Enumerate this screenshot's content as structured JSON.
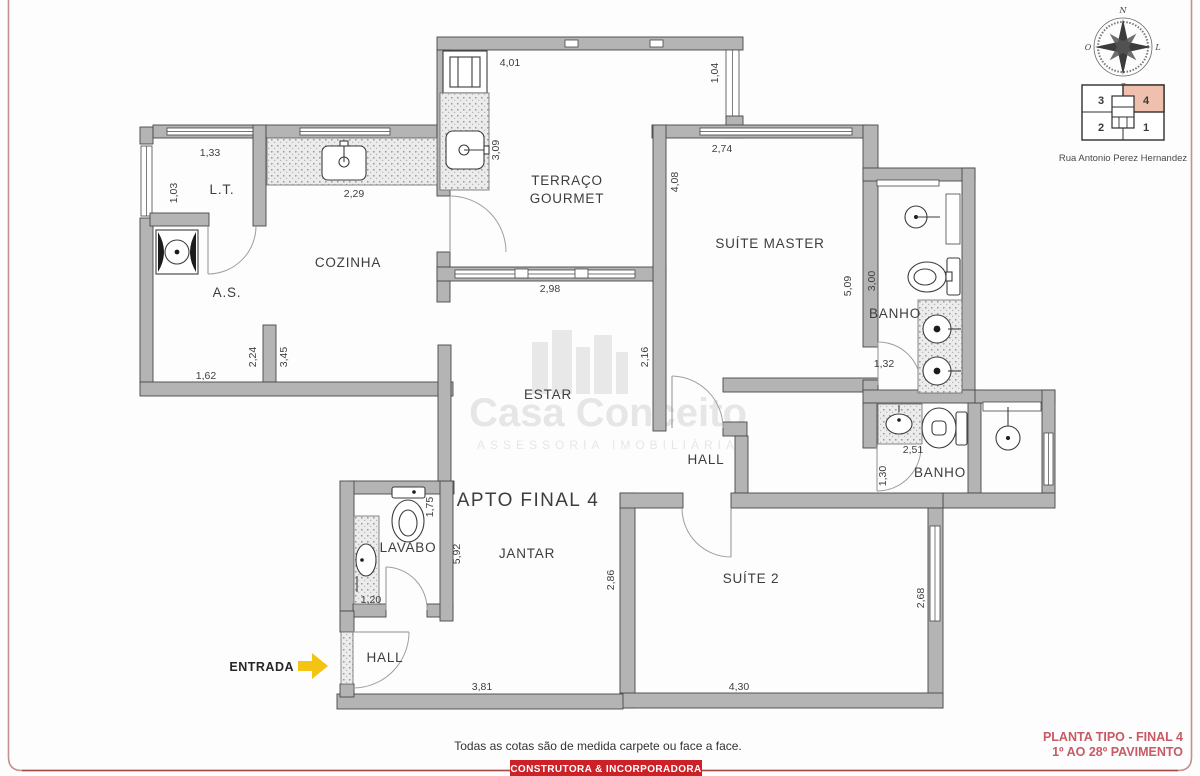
{
  "palette": {
    "wall_gray": "#b4b4b4",
    "accent_red": "#cb2127",
    "title_red": "#c75a64",
    "border_pink": "#c2928e",
    "arrow_yellow": "#f4c412",
    "keyplan_highlight": "#eec0ad"
  },
  "rooms": {
    "lt": "L.T.",
    "servico": "A.S.",
    "cozinha": "COZINHA",
    "terraco1": "TERRAÇO",
    "terraco2": "GOURMET",
    "suite_master": "SUÍTE MASTER",
    "banho_master": "BANHO",
    "estar": "ESTAR",
    "hall": "HALL",
    "apto": "APTO FINAL 4",
    "jantar": "JANTAR",
    "lavabo": "LAVABO",
    "banho2": "BANHO",
    "suite2": "SUÍTE 2",
    "hall_entrada": "HALL"
  },
  "dims": {
    "d401": "4,01",
    "d104": "1,04",
    "d274": "2,74",
    "d408": "4,08",
    "d133": "1,33",
    "d103": "1,03",
    "d229": "2,29",
    "d309": "3,09",
    "d298": "2,98",
    "d509": "5,09",
    "d300": "3,00",
    "d132": "1,32",
    "d224": "2,24",
    "d345": "3,45",
    "d162": "1,62",
    "d216": "2,16",
    "d251": "2,51",
    "d130": "1,30",
    "d175": "1,75",
    "d592": "5,92",
    "d120": "1,20",
    "d286": "2,86",
    "d268": "2,68",
    "d381": "3,81",
    "d430": "4,30"
  },
  "entrada": {
    "label": "ENTRADA"
  },
  "compass": {
    "n": "N",
    "s": "S",
    "l": "L",
    "o": "O"
  },
  "key_plan": {
    "unit_tl": "3",
    "unit_tr": "4",
    "unit_bl": "2",
    "unit_br": "1",
    "highlighted_unit": "4",
    "street": "Rua Antonio Perez Hernandez"
  },
  "watermark": {
    "brand": "Casa Conceito",
    "tagline": "ASSESSORIA IMOBILIÁRIA"
  },
  "footer": {
    "note": "Todas as cotas são de medida carpete ou face a face.",
    "banner": "CONSTRUTORA & INCORPORADORA",
    "plan_title": "PLANTA TIPO - FINAL 4",
    "plan_subtitle": "1º AO 28º PAVIMENTO"
  }
}
